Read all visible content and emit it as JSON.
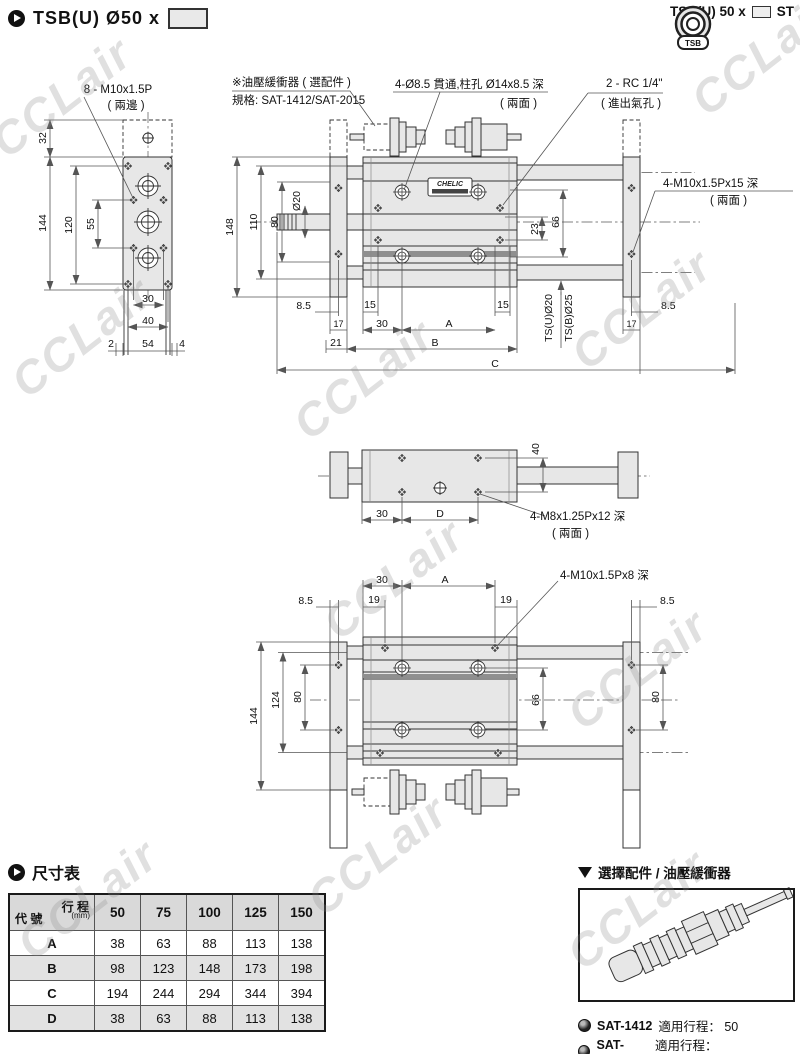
{
  "watermark": "CCLair",
  "header": {
    "left_title": "TSB(U)  Ø50 x",
    "right_title": "TSB(U) 50 x",
    "right_suffix": "ST",
    "icon_text": "TSB"
  },
  "front_view": {
    "buffer_note1": "※油壓緩衝器 ( 選配件 )",
    "buffer_note2": "規格: SAT-1412/SAT-2015",
    "hole_note1": "4-Ø8.5 貫通,柱孔 Ø14x8.5 深",
    "hole_note2": "( 兩面 )",
    "port_note1": "2 - RC 1/4\"",
    "port_note2": "( 進出氣孔 )",
    "thread_note1": "4-M10x1.5Px15 深",
    "thread_note2": "( 兩面 )",
    "nameplate": "CHELIC",
    "d148": "148",
    "d110": "110",
    "d80": "80",
    "dia20": "Ø20",
    "d23": "23",
    "d66": "66",
    "rod_u": "TS(U)Ø20",
    "rod_b": "TS(B)Ø25",
    "d85l": "8.5",
    "d15l": "15",
    "d15r": "15",
    "d85r": "8.5",
    "d17l": "17",
    "d30": "30",
    "dA": "A",
    "d17r": "17",
    "d21": "21",
    "dB": "B",
    "dC": "C"
  },
  "end_view": {
    "note1": "8 - M10x1.5P",
    "note2": "( 兩邊 )",
    "d32": "32",
    "d144": "144",
    "d120": "120",
    "d55": "55",
    "d30": "30",
    "d40": "40",
    "d2": "2",
    "d54": "54",
    "d4": "4"
  },
  "side_view": {
    "d40": "40",
    "d30": "30",
    "dD": "D",
    "note1": "4-M8x1.25Px12 深",
    "note2": "( 兩面 )"
  },
  "bottom_view": {
    "d30": "30",
    "dA": "A",
    "d19l": "19",
    "d19r": "19",
    "d85l": "8.5",
    "d85r": "8.5",
    "note": "4-M10x1.5Px8 深",
    "d144": "144",
    "d124": "124",
    "d80l": "80",
    "d66": "66",
    "d80r": "80"
  },
  "table": {
    "title": "尺寸表",
    "corner_top": "行 程",
    "corner_unit": "(mm)",
    "corner_bottom": "代 號",
    "columns": [
      "50",
      "75",
      "100",
      "125",
      "150"
    ],
    "rows": [
      {
        "label": "A",
        "values": [
          "38",
          "63",
          "88",
          "113",
          "138"
        ]
      },
      {
        "label": "B",
        "values": [
          "98",
          "123",
          "148",
          "173",
          "198"
        ]
      },
      {
        "label": "C",
        "values": [
          "194",
          "244",
          "294",
          "344",
          "394"
        ]
      },
      {
        "label": "D",
        "values": [
          "38",
          "63",
          "88",
          "113",
          "138"
        ]
      }
    ]
  },
  "accessory": {
    "title": "選擇配件 / 油壓緩衝器",
    "items": [
      {
        "model": "SAT-1412",
        "desc": "適用行程： 50"
      },
      {
        "model": "SAT-2015",
        "desc": "適用行程： 75,100,125,150"
      }
    ]
  }
}
